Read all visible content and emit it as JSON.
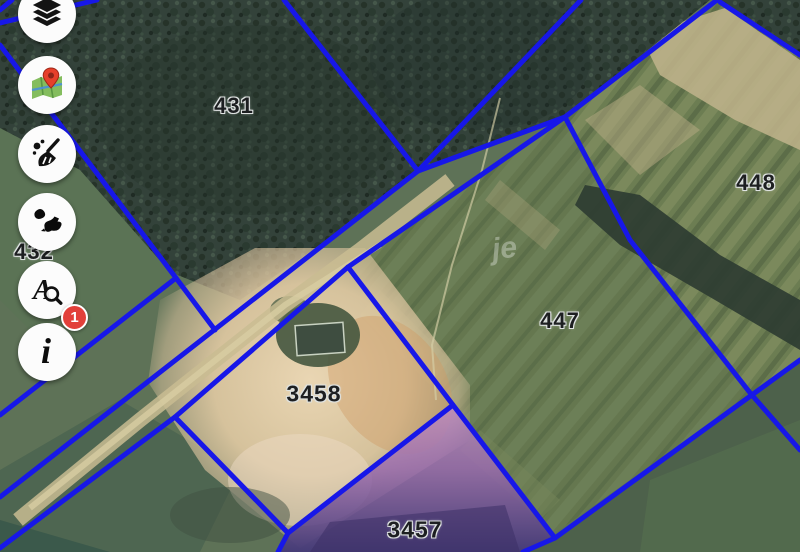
{
  "map": {
    "boundary_color": "#1717e8",
    "highlighted_parcel": "3457",
    "highlight_color": "#9a6bae",
    "watermark": "je",
    "parcels": [
      {
        "id": "431"
      },
      {
        "id": "432"
      },
      {
        "id": "447"
      },
      {
        "id": "448"
      },
      {
        "id": "3458"
      },
      {
        "id": "3457"
      }
    ]
  },
  "toolbar": {
    "badge_count": "1",
    "badge_color": "#e2403a",
    "search_glyph": "A",
    "info_glyph": "i"
  }
}
